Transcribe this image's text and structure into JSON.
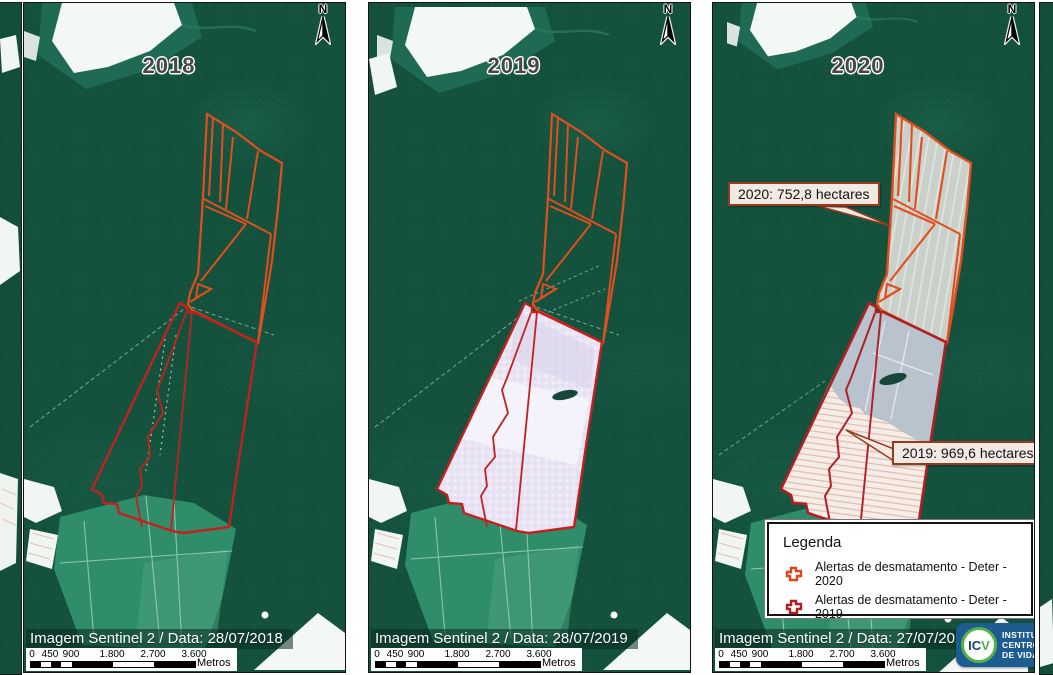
{
  "panels": [
    {
      "year": "2018",
      "caption": "Imagem Sentinel 2 / Data: 28/07/2018"
    },
    {
      "year": "2019",
      "caption": "Imagem Sentinel 2 / Data: 28/07/2019"
    },
    {
      "year": "2020",
      "caption": "Imagem Sentinel 2 / Data: 27/07/2020"
    }
  ],
  "north": {
    "label": "N"
  },
  "scalebar": {
    "ticks": [
      "0",
      "450",
      "900",
      "1.800",
      "2.700",
      "3.600"
    ],
    "unit": "Metros"
  },
  "annotations": {
    "callout_2020": "2020: 752,8 hectares",
    "callout_2019": "2019: 969,6 hectares"
  },
  "legend": {
    "title": "Legenda",
    "items": [
      {
        "label": "Alertas de desmatamento - Deter - 2020",
        "color": "#e0461c"
      },
      {
        "label": "Alertas de desmatamento - Deter - 2019",
        "color": "#b01f24"
      }
    ]
  },
  "logo": {
    "acronym_prefix": "IC",
    "acronym_suffix": "V",
    "lines": [
      "INSTITUTO",
      "CENTRO",
      "DE VIDA"
    ]
  },
  "colors": {
    "alert_2020": "#e34e1d",
    "alert_2019": "#c42020",
    "forest": "#14523e",
    "cleared_2019_panel2": "#e8e4f3",
    "cleared_2020_panel3": "#cad0ca",
    "cleared_2019_panel3": "#f6ede7",
    "logo_blue": "#1d5c90",
    "logo_green": "#55b345"
  }
}
